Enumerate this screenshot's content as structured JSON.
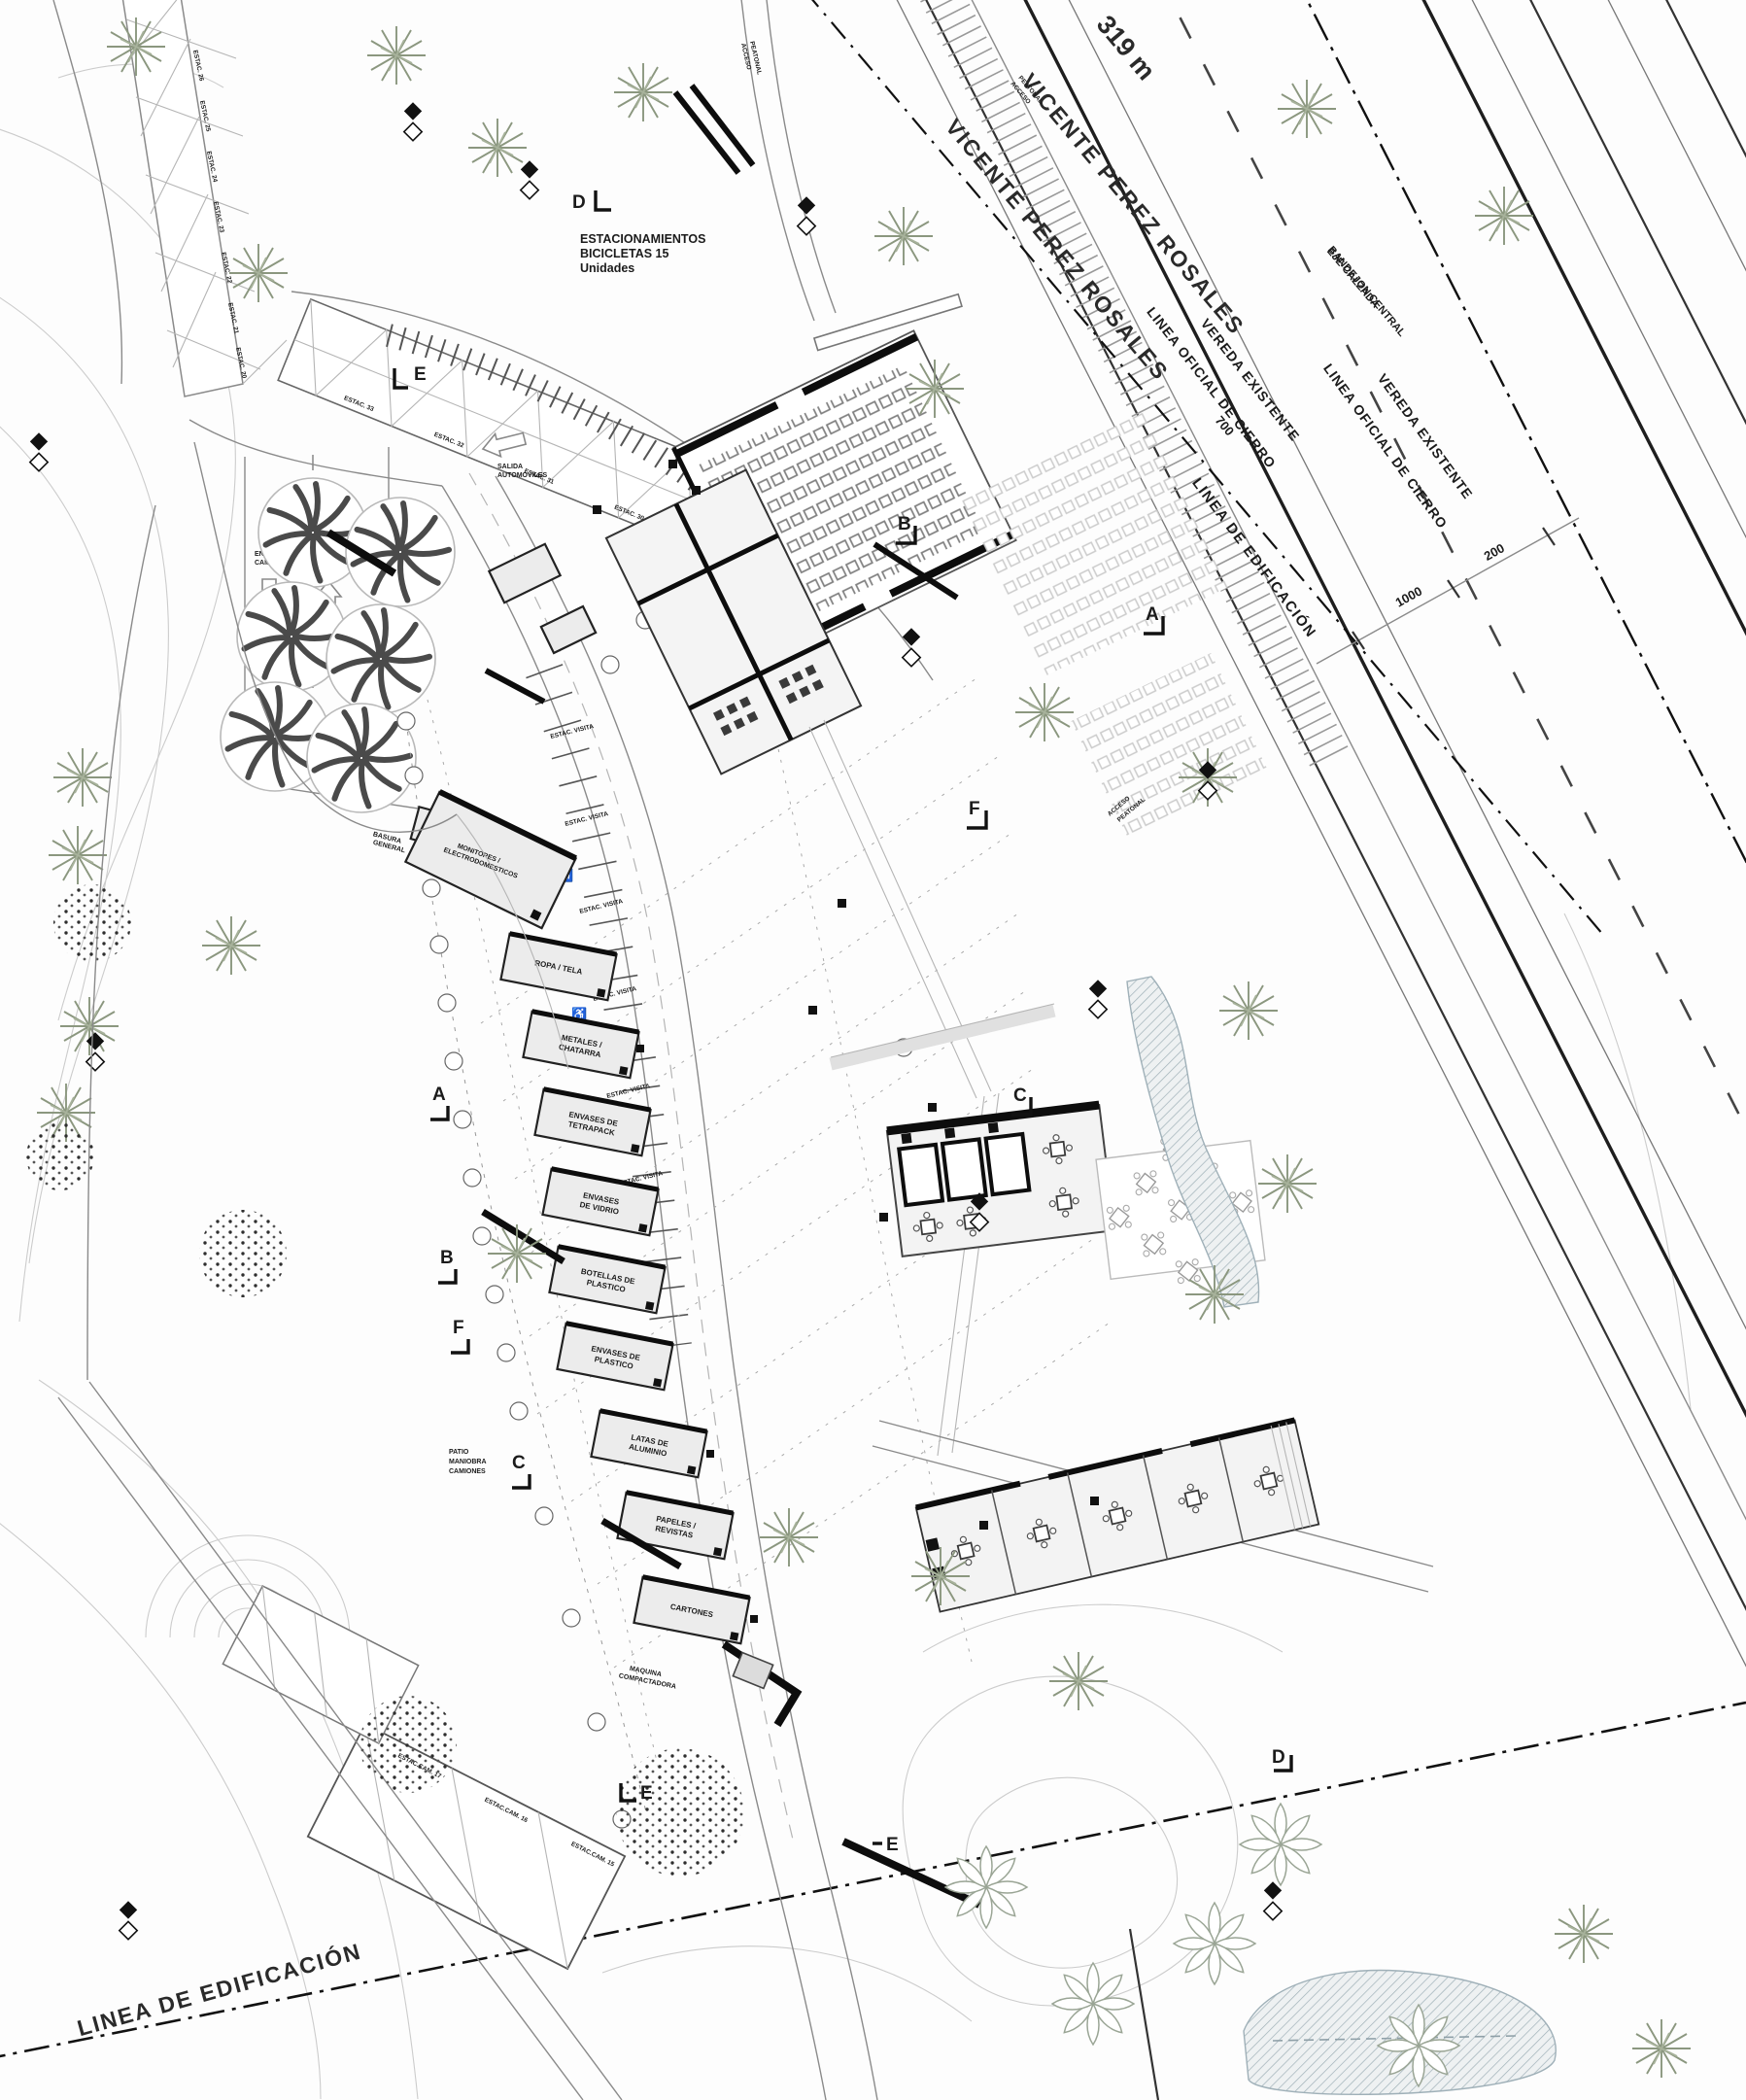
{
  "palette": {
    "ink": "#1b1b1b",
    "line_gray": "#8a8a8a",
    "light_gray": "#c7c7c7",
    "building_fill": "#ececec",
    "tree_green": "#8b977f",
    "water": "#aebbc2"
  },
  "road": {
    "street_name_upper": "VICENTE PEREZ ROSALES",
    "street_name_lower": "VICENTE PEREZ ROSALES",
    "length_label": "319 m",
    "axis_line1": "EJE CALZADA",
    "axis_line2": "BANDEJON CENTRAL",
    "dim_700": "700",
    "dim_1000": "1000",
    "dim_200": "200"
  },
  "boundaries": {
    "building_line_top": "LINEA DE EDIFICACIÓN",
    "official_closure_line": "LINEA OFICIAL DE CIERRO",
    "existing_sidewalk": "VEREDA EXISTENTE",
    "building_line_bottom": "LINEA DE EDIFICACIÓN"
  },
  "bike_parking": {
    "line1": "ESTACIONAMIENTOS",
    "line2": "BICICLETAS 15",
    "line3": "Unidades"
  },
  "circulation": {
    "car_exit_l1": "SALIDA",
    "car_exit_l2": "AUTOMOVILES",
    "truck_in_l1": "ENTRADA",
    "truck_in_l2": "CAMIONES",
    "truck_out_l1": "SALIDA",
    "truck_out_l2": "CAMIONES",
    "yard_l1": "PATIO",
    "yard_l2": "MANIOBRA",
    "yard_l3": "CAMIONES",
    "ped_l1": "ACCESO",
    "ped_l2": "PEATONAL"
  },
  "buildings": {
    "general_waste_l1": "BASURA",
    "general_waste_l2": "GENERAL",
    "monitors_l1": "MONITORES /",
    "monitors_l2": "ELECTRODOMESTICOS",
    "compactor_l1": "MAQUINA",
    "compactor_l2": "COMPACTADORA",
    "recycling": [
      {
        "l1": "ROPA / TELA",
        "l2": ""
      },
      {
        "l1": "METALES /",
        "l2": "CHATARRA"
      },
      {
        "l1": "ENVASES DE",
        "l2": "TETRAPACK"
      },
      {
        "l1": "ENVASES",
        "l2": "DE VIDRIO"
      },
      {
        "l1": "BOTELLAS DE",
        "l2": "PLASTICO"
      },
      {
        "l1": "ENVASES DE",
        "l2": "PLASTICO"
      },
      {
        "l1": "LATAS DE",
        "l2": "ALUMINIO"
      },
      {
        "l1": "PAPELES /",
        "l2": "REVISTAS"
      },
      {
        "l1": "CARTONES",
        "l2": ""
      }
    ]
  },
  "parking": {
    "visitor_stall": "ESTAC. VISITA",
    "upper_stalls": [
      "ESTAC. 33",
      "ESTAC. 32",
      "ESTAC. 31",
      "ESTAC. 30"
    ],
    "left_stalls": [
      "ESTAC. 26",
      "ESTAC. 25",
      "ESTAC. 24",
      "ESTAC. 23",
      "ESTAC. 22",
      "ESTAC. 21",
      "ESTAC. 20"
    ],
    "truck_stalls": [
      "ESTAC.CAM. 17",
      "ESTAC.CAM. 16",
      "ESTAC.CAM. 15"
    ]
  },
  "markers": {
    "a": "A",
    "b": "B",
    "c": "C",
    "d": "D",
    "e": "E",
    "f": "F"
  }
}
